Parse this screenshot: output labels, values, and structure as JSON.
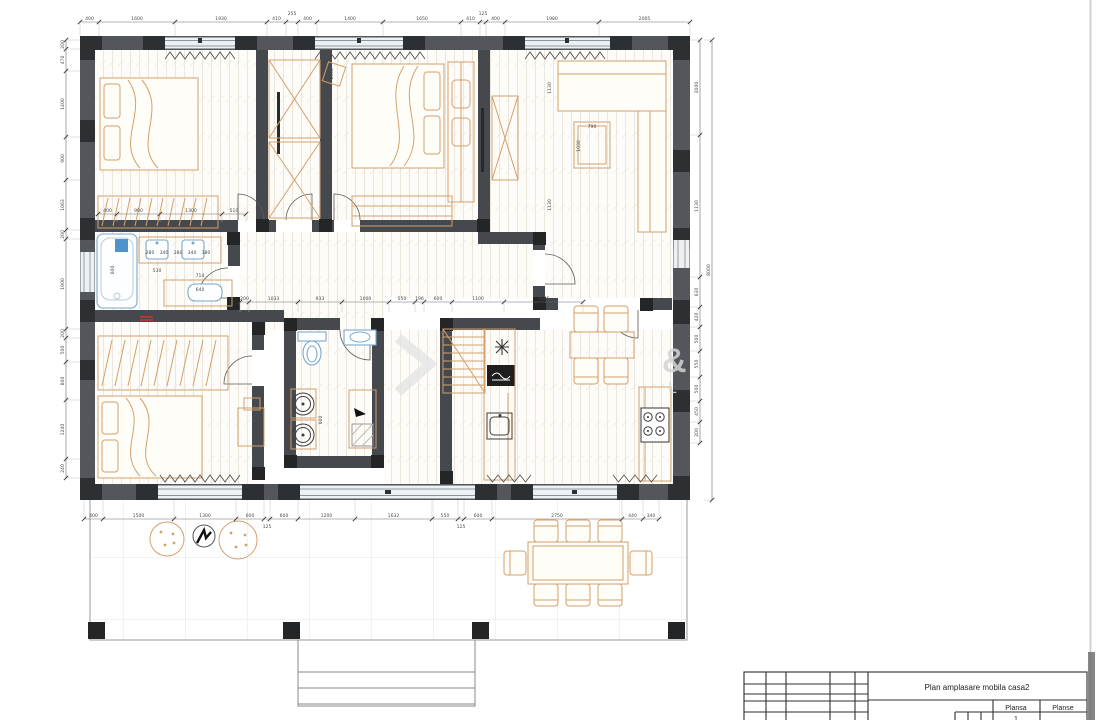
{
  "sheet": {
    "title": "Plan amplasare mobila casa2",
    "col_plansa": "Plansa",
    "col_planse": "Planse",
    "sheet_number": "1"
  },
  "watermark": {
    "glyph_amp": "&",
    "glyph_l": "L"
  },
  "dims": {
    "top": [
      "400",
      "1600",
      "1930",
      "410",
      "255",
      "400",
      "1400",
      "1650",
      "410",
      "125",
      "400",
      "1980",
      "2005"
    ],
    "bottom": [
      "400",
      "1500",
      "1300",
      "600",
      "125",
      "600",
      "1200",
      "1632",
      "550",
      "125",
      "600",
      "2750",
      "440",
      "340"
    ],
    "left": [
      "200",
      "470",
      "1400",
      "900",
      "1063",
      "200",
      "1900",
      "200",
      "500",
      "800",
      "1240",
      "240"
    ],
    "right": [
      "2000",
      "1130",
      "630",
      "420",
      "500",
      "550",
      "500",
      "450",
      "200"
    ],
    "right_outer": [
      "8000"
    ],
    "hall": [
      "200",
      "1033",
      "933",
      "1000",
      "550",
      "196",
      "600",
      "1100",
      "1665"
    ],
    "wardrobe1": [
      "400",
      "900",
      "1300",
      "510"
    ],
    "interior": [
      "600",
      "530",
      "714",
      "640",
      "280",
      "340",
      "280",
      "340",
      "180",
      "790",
      "1030",
      "1130",
      "1130",
      "1500",
      "600"
    ]
  }
}
